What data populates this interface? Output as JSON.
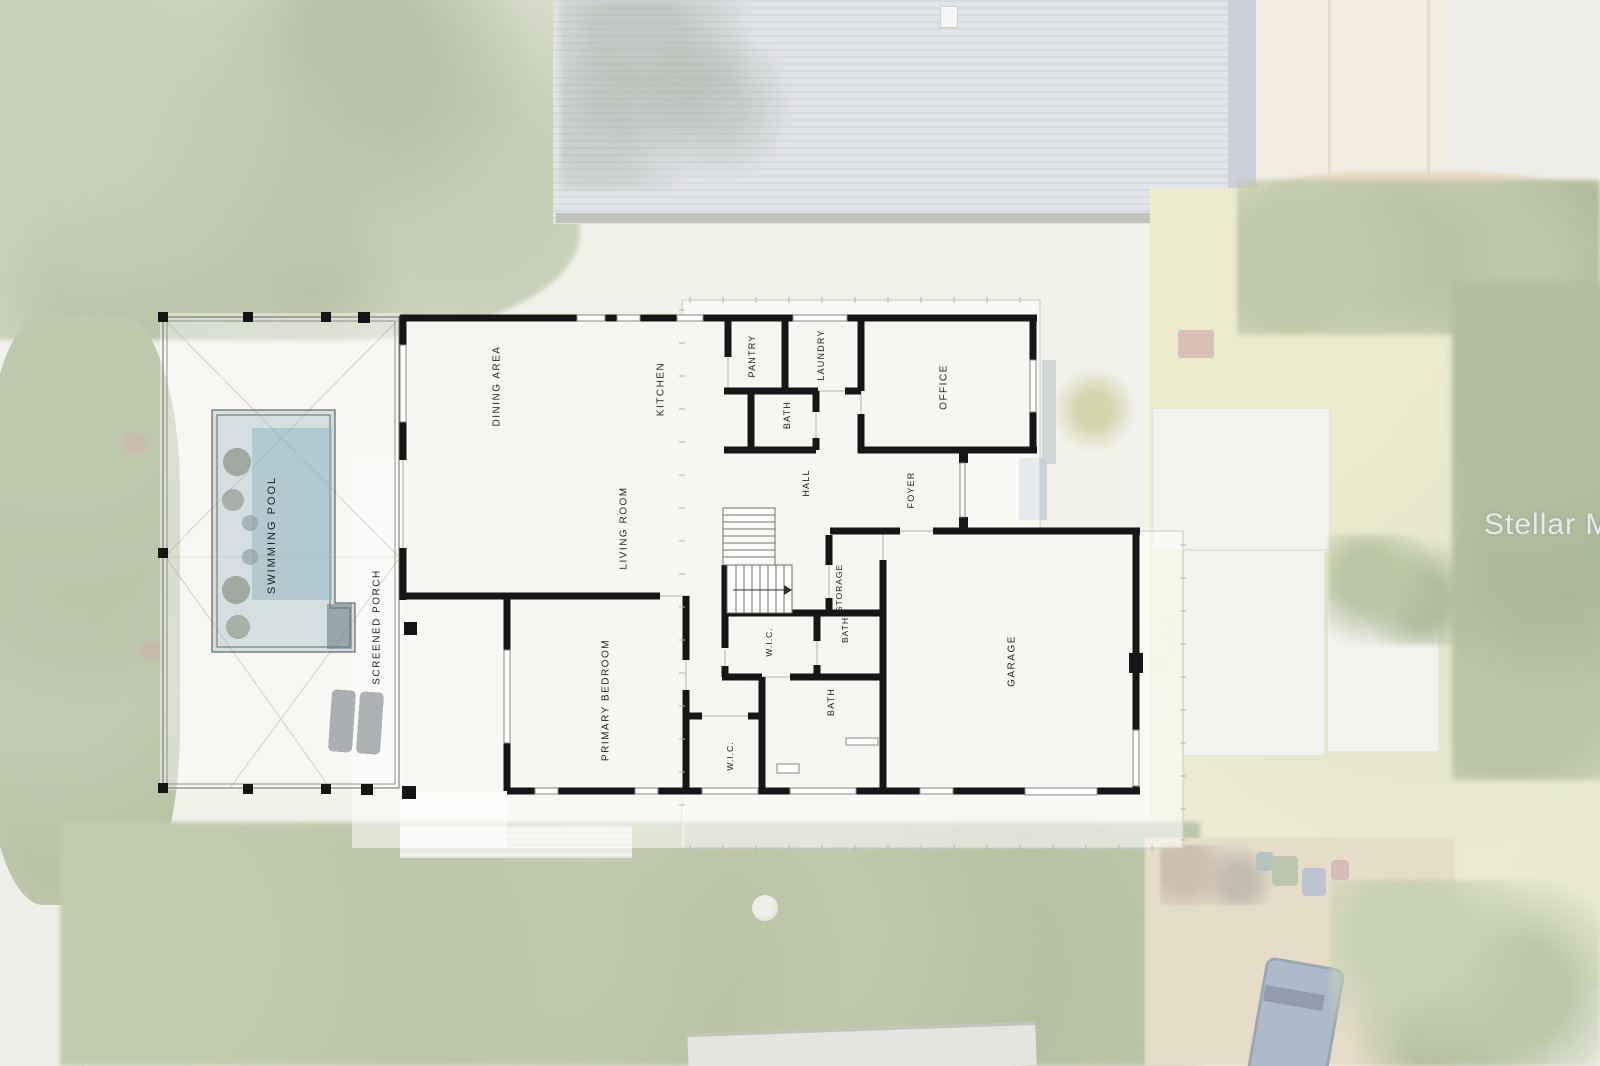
{
  "watermark": {
    "text": "Stellar MLS"
  },
  "floor_plan": {
    "rooms": [
      {
        "id": "swimming-pool",
        "label": "SWIMMING POOL",
        "x": 272,
        "y": 535,
        "fs": 11,
        "ls": 2
      },
      {
        "id": "screened-porch",
        "label": "SCREENED PORCH",
        "x": 377,
        "y": 627,
        "fs": 10,
        "ls": 1.5
      },
      {
        "id": "dining-area",
        "label": "DINING AREA",
        "x": 497,
        "y": 386,
        "fs": 10,
        "ls": 1.5
      },
      {
        "id": "kitchen",
        "label": "KITCHEN",
        "x": 661,
        "y": 389,
        "fs": 10,
        "ls": 1.5
      },
      {
        "id": "living-room",
        "label": "LIVING ROOM",
        "x": 624,
        "y": 528,
        "fs": 10,
        "ls": 1.5
      },
      {
        "id": "primary-bedroom",
        "label": "PRIMARY BEDROOM",
        "x": 606,
        "y": 700,
        "fs": 10,
        "ls": 1.5
      },
      {
        "id": "pantry",
        "label": "PANTRY",
        "x": 752,
        "y": 356,
        "fs": 9,
        "ls": 1.2
      },
      {
        "id": "laundry",
        "label": "LAUNDRY",
        "x": 821,
        "y": 355,
        "fs": 9,
        "ls": 1.2
      },
      {
        "id": "bath-upper",
        "label": "BATH",
        "x": 787,
        "y": 415,
        "fs": 9,
        "ls": 1.2
      },
      {
        "id": "office",
        "label": "OFFICE",
        "x": 944,
        "y": 387,
        "fs": 10,
        "ls": 1.5
      },
      {
        "id": "hall",
        "label": "HALL",
        "x": 806,
        "y": 483,
        "fs": 9,
        "ls": 1.2
      },
      {
        "id": "foyer",
        "label": "FOYER",
        "x": 911,
        "y": 490,
        "fs": 9,
        "ls": 1.2
      },
      {
        "id": "storage",
        "label": "STORAGE",
        "x": 839,
        "y": 588,
        "fs": 8.5,
        "ls": 1
      },
      {
        "id": "wic-upper",
        "label": "W.I.C.",
        "x": 769,
        "y": 642,
        "fs": 8.5,
        "ls": 1
      },
      {
        "id": "bath-middle",
        "label": "BATH",
        "x": 845,
        "y": 630,
        "fs": 8.5,
        "ls": 1
      },
      {
        "id": "bath-lower",
        "label": "BATH",
        "x": 831,
        "y": 702,
        "fs": 9,
        "ls": 1.2
      },
      {
        "id": "wic-lower",
        "label": "W.I.C.",
        "x": 730,
        "y": 756,
        "fs": 8.5,
        "ls": 1
      },
      {
        "id": "garage",
        "label": "GARAGE",
        "x": 1012,
        "y": 661,
        "fs": 10,
        "ls": 1.5
      }
    ]
  },
  "colors": {
    "wall": "#161616",
    "label_text": "#222222",
    "pool_water": "#8fb3bd",
    "backdrop_white": "#ffffff"
  }
}
